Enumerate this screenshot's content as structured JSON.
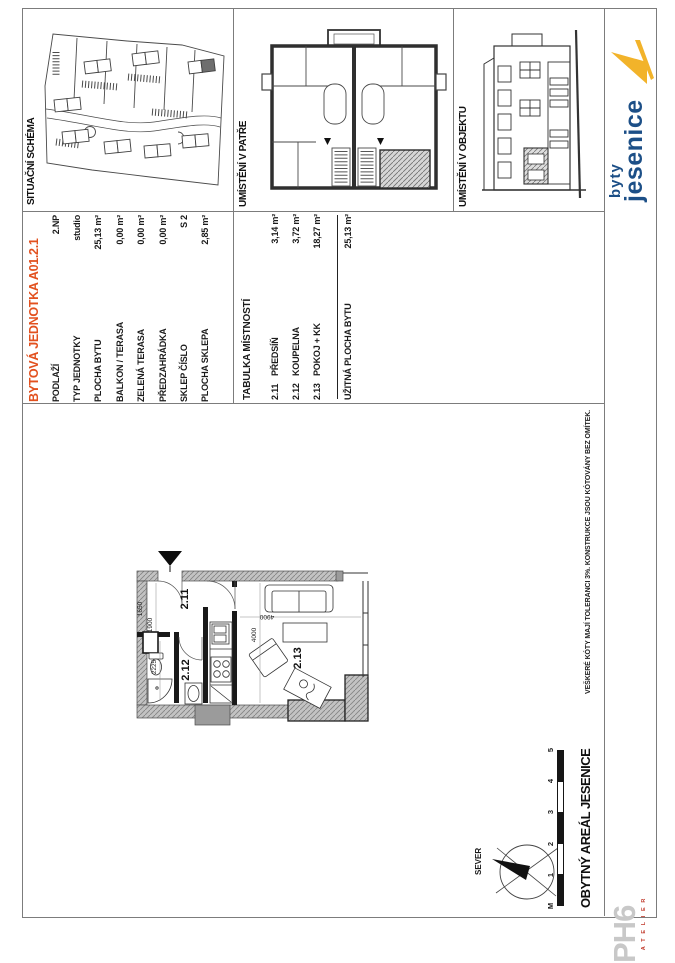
{
  "panels": {
    "situace": {
      "label": "SITUAČNÍ SCHÉMA"
    },
    "patro": {
      "label": "UMÍSTĚNÍ V PATŘE"
    },
    "objekt": {
      "label": "UMÍSTĚNÍ V OBJEKTU"
    }
  },
  "unit": {
    "title": "BYTOVÁ JEDNOTKA A01.2.1",
    "rows": [
      {
        "label": "PODLAŽÍ",
        "value": "2.NP"
      },
      {
        "label": "TYP JEDNOTKY",
        "value": "studio"
      },
      {
        "label": "PLOCHA BYTU",
        "value": "25,13 m²"
      },
      {
        "label": "BALKON / TERASA",
        "value": "0,00 m²"
      },
      {
        "label": "ZELENÁ TERASA",
        "value": "0,00 m²"
      },
      {
        "label": "PŘEDZAHRÁDKA",
        "value": "0,00 m²"
      },
      {
        "label": "SKLEP ČÍSLO",
        "value": "S 2"
      },
      {
        "label": "PLOCHA SKLEPA",
        "value": "2,85 m²"
      }
    ]
  },
  "rooms": {
    "title": "TABULKA MÍSTNOSTÍ",
    "rows": [
      {
        "num": "2.11",
        "name": "PŘEDSÍŇ",
        "area": "3,14 m²"
      },
      {
        "num": "2.12",
        "name": "KOUPELNA",
        "area": "3,72 m²"
      },
      {
        "num": "2.13",
        "name": "POKOJ + KK",
        "area": "18,27 m²"
      }
    ],
    "total_label": "UŽITNÁ PLOCHA BYTU",
    "total_value": "25,13 m²"
  },
  "floorplan": {
    "room_labels": [
      "2.11",
      "2.12",
      "2.13"
    ],
    "dimensions": [
      "1650",
      "1900",
      "2225",
      "4000",
      "4900"
    ]
  },
  "disclaimer": "VEŠKERÉ KÓTY MAJÍ TOLERANCI 3%. KONSTRUKCE JSOU KÓTOVÁNY BEZ OMÍTEK.",
  "titleblock": {
    "project": "OBYTNÝ AREÁL JESENICE",
    "north_label": "SEVER",
    "scalebar_labels": [
      "M",
      "1",
      "2",
      "3",
      "4",
      "5"
    ]
  },
  "brand": {
    "logo_line1": "byty",
    "logo_line2": "jesenice",
    "studio_name": "PH6",
    "studio_sub": "A T E L I E R"
  },
  "colors": {
    "accent_orange": "#e2511f",
    "logo_blue": "#1c4f87",
    "logo_yellow": "#f2b32a",
    "ph6_gray": "#c8c8c8",
    "ph6_red": "#c0392b",
    "frame_gray": "#7c7c7c"
  }
}
